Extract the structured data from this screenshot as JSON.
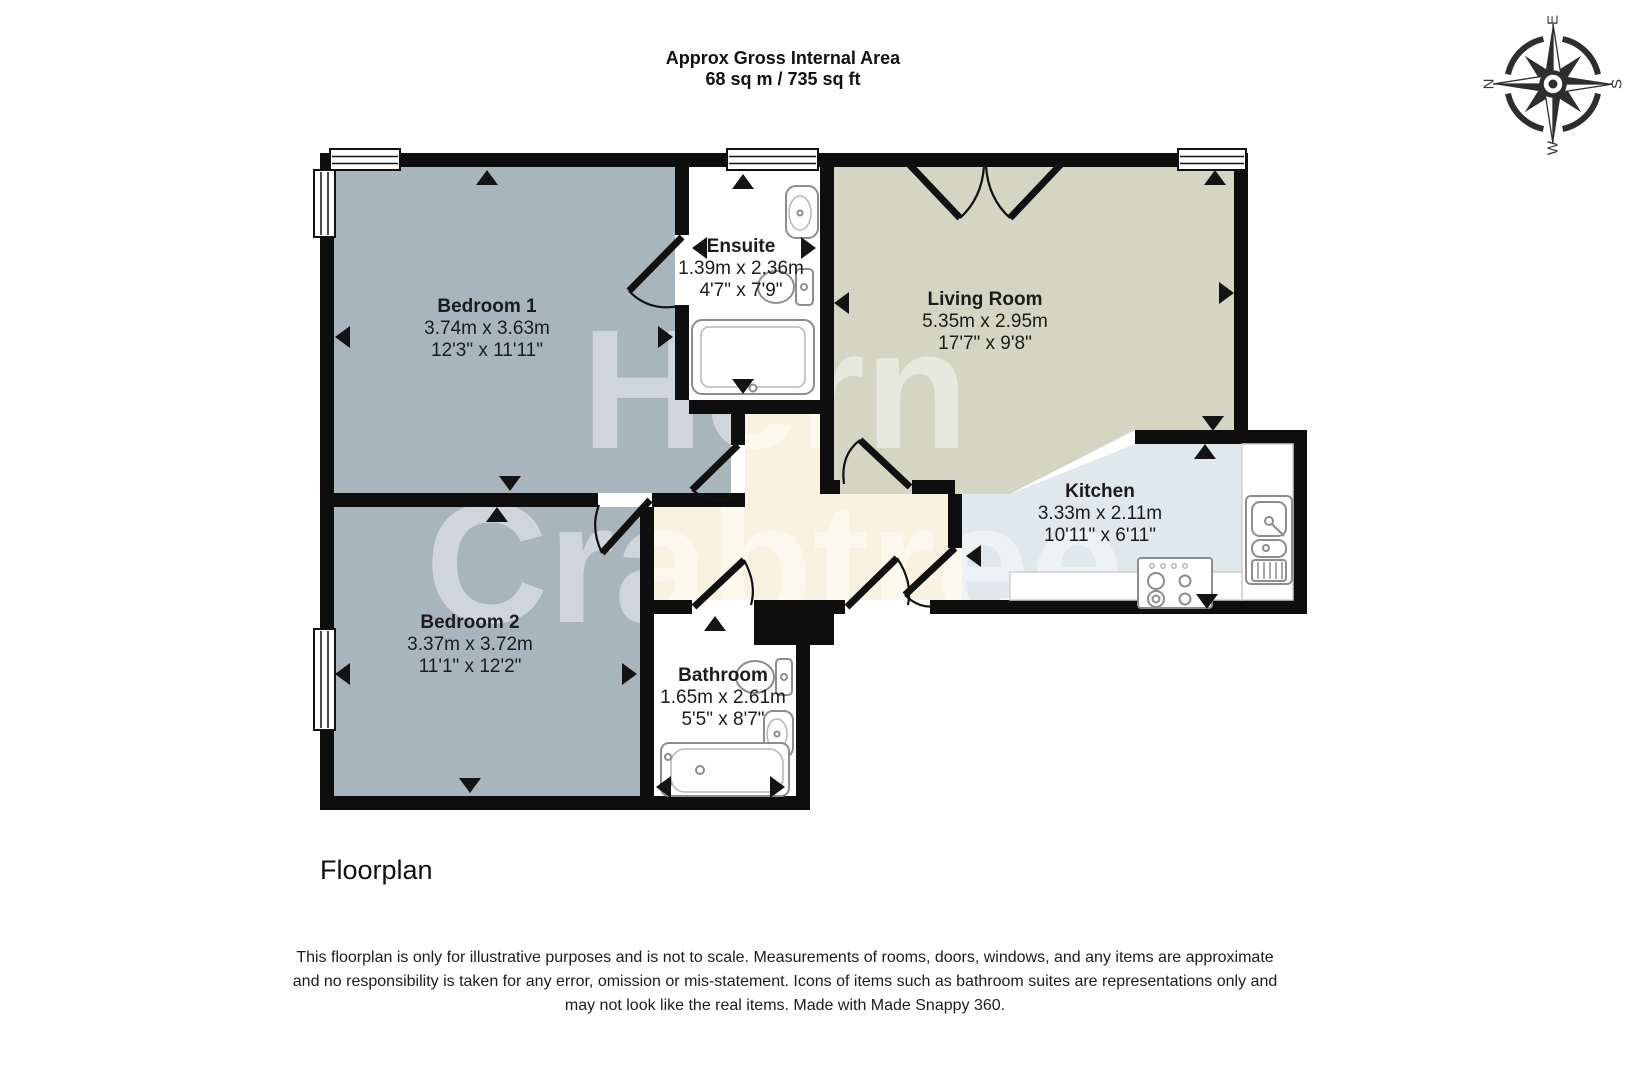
{
  "header": {
    "title_line1": "Approx Gross Internal Area",
    "title_line2": "68 sq m / 735 sq ft"
  },
  "compass": {
    "n": "N",
    "e": "E",
    "s": "S",
    "w": "W"
  },
  "watermark": {
    "line1": "Hern",
    "line2": "Crabtree"
  },
  "rooms": {
    "bedroom1": {
      "name": "Bedroom 1",
      "metric": "3.74m x 3.63m",
      "imperial": "12'3\" x 11'11\""
    },
    "ensuite": {
      "name": "Ensuite",
      "metric": "1.39m x 2.36m",
      "imperial": "4'7\" x 7'9\""
    },
    "living": {
      "name": "Living Room",
      "metric": "5.35m x 2.95m",
      "imperial": "17'7\" x 9'8\""
    },
    "kitchen": {
      "name": "Kitchen",
      "metric": "3.33m x 2.11m",
      "imperial": "10'11\" x 6'11\""
    },
    "bedroom2": {
      "name": "Bedroom 2",
      "metric": "3.37m x 3.72m",
      "imperial": "11'1\" x 12'2\""
    },
    "bathroom": {
      "name": "Bathroom",
      "metric": "1.65m x 2.61m",
      "imperial": "5'5\" x 8'7\""
    }
  },
  "footer": {
    "caption": "Floorplan",
    "disclaimer_line1": "This floorplan is only for illustrative purposes and is not to scale. Measurements of rooms, doors, windows, and any items are approximate",
    "disclaimer_line2": "and no responsibility is taken for any error, omission or mis-statement. Icons of items such as bathroom suites are representations only and",
    "disclaimer_line3": "may not look like the real items. Made with Made Snappy 360."
  },
  "colors": {
    "bedroom_floor": "#a8b5bd",
    "living_floor": "#d4d5c3",
    "kitchen_floor": "#dfe8eb",
    "hall_floor": "#f8f2e1",
    "wall": "#0e0e0e",
    "white_room": "#ffffff"
  }
}
